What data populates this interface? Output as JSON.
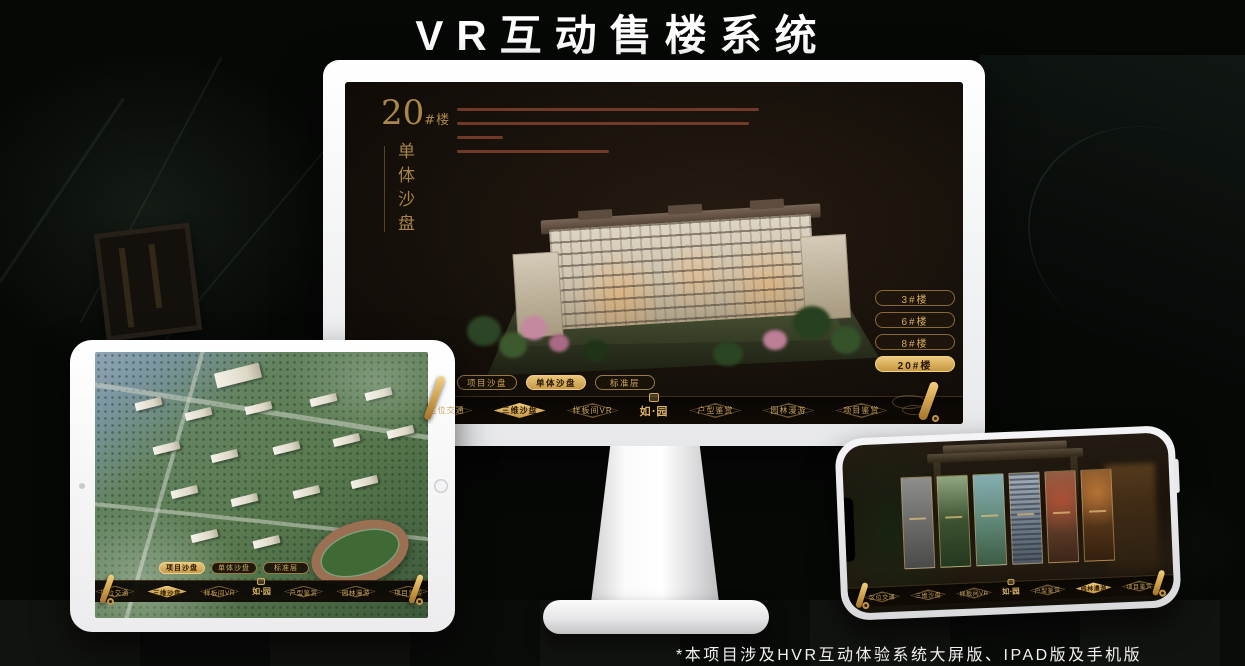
{
  "page": {
    "title": "VR互动售楼系统",
    "footnote": "*本项目涉及HVR互动体验系统大屏版、IPAD版及手机版"
  },
  "colors": {
    "gold_accent": "#c9a35c",
    "gold_active": "#d9ad62",
    "screen_background": "#16100b",
    "title_text": "#ffffff"
  },
  "nav": {
    "logo": "如·园",
    "items": [
      {
        "label": "区位交通"
      },
      {
        "label": "三维沙盘"
      },
      {
        "label": "样板间VR"
      },
      {
        "label": "户型鉴赏"
      },
      {
        "label": "园林漫游"
      },
      {
        "label": "项目鉴赏"
      }
    ]
  },
  "mode_tabs": [
    {
      "label": "项目沙盘"
    },
    {
      "label": "单体沙盘"
    },
    {
      "label": "标准层"
    }
  ],
  "monitor": {
    "heading_number": "20",
    "heading_suffix": "#楼",
    "heading_vertical": "单体沙盘",
    "floor_buttons": [
      {
        "label": "3#楼"
      },
      {
        "label": "6#楼"
      },
      {
        "label": "8#楼"
      },
      {
        "label": "20#楼"
      }
    ]
  }
}
